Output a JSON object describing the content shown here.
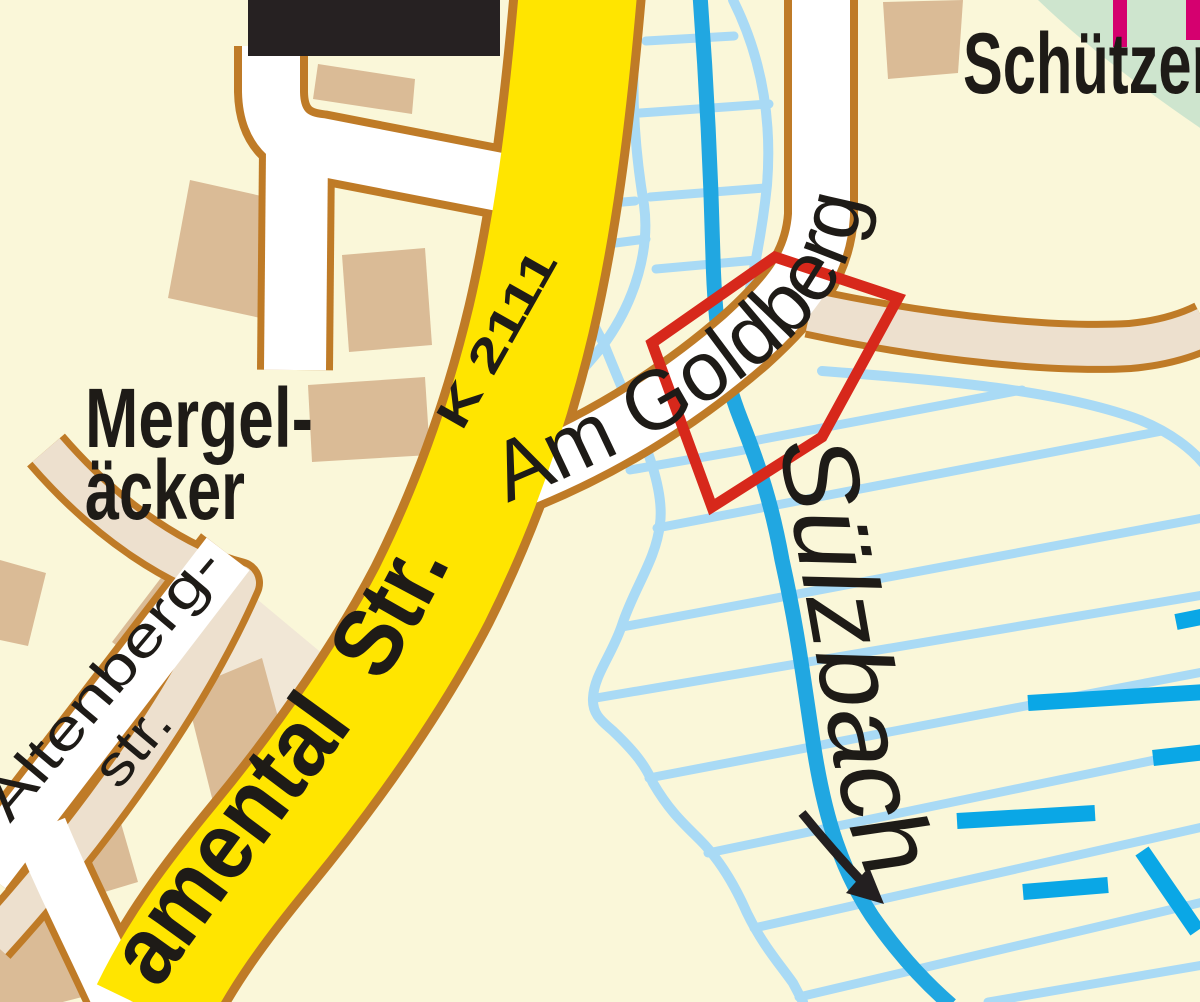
{
  "map": {
    "labels": {
      "area_green": "Schützen",
      "district_line1": "Mergel-",
      "district_line2": "äcker",
      "street_side_line1": "Altenberg-",
      "street_side_line2": "str.",
      "road_ref": "K 2111",
      "road_main": "amental  Str.",
      "street_goldberg": "Am Goldberg",
      "stream": "Sülzbach"
    },
    "colors": {
      "background": "#FAF7D9",
      "major_road": "#FFE500",
      "road_casing": "#BF7B27",
      "minor_road": "#FFFFFF",
      "track_road": "#EDE0CE",
      "building": "#DABB96",
      "building_dark": "#262122",
      "stream": "#21A7E1",
      "wetland_hatch": "#A9DAF5",
      "water_dash": "#0AA7E6",
      "highlight_outline": "#D7281B",
      "greenspace": "#CEE5CE",
      "boundary_marker": "#D5006F",
      "label_text": "#1E1B17"
    }
  }
}
